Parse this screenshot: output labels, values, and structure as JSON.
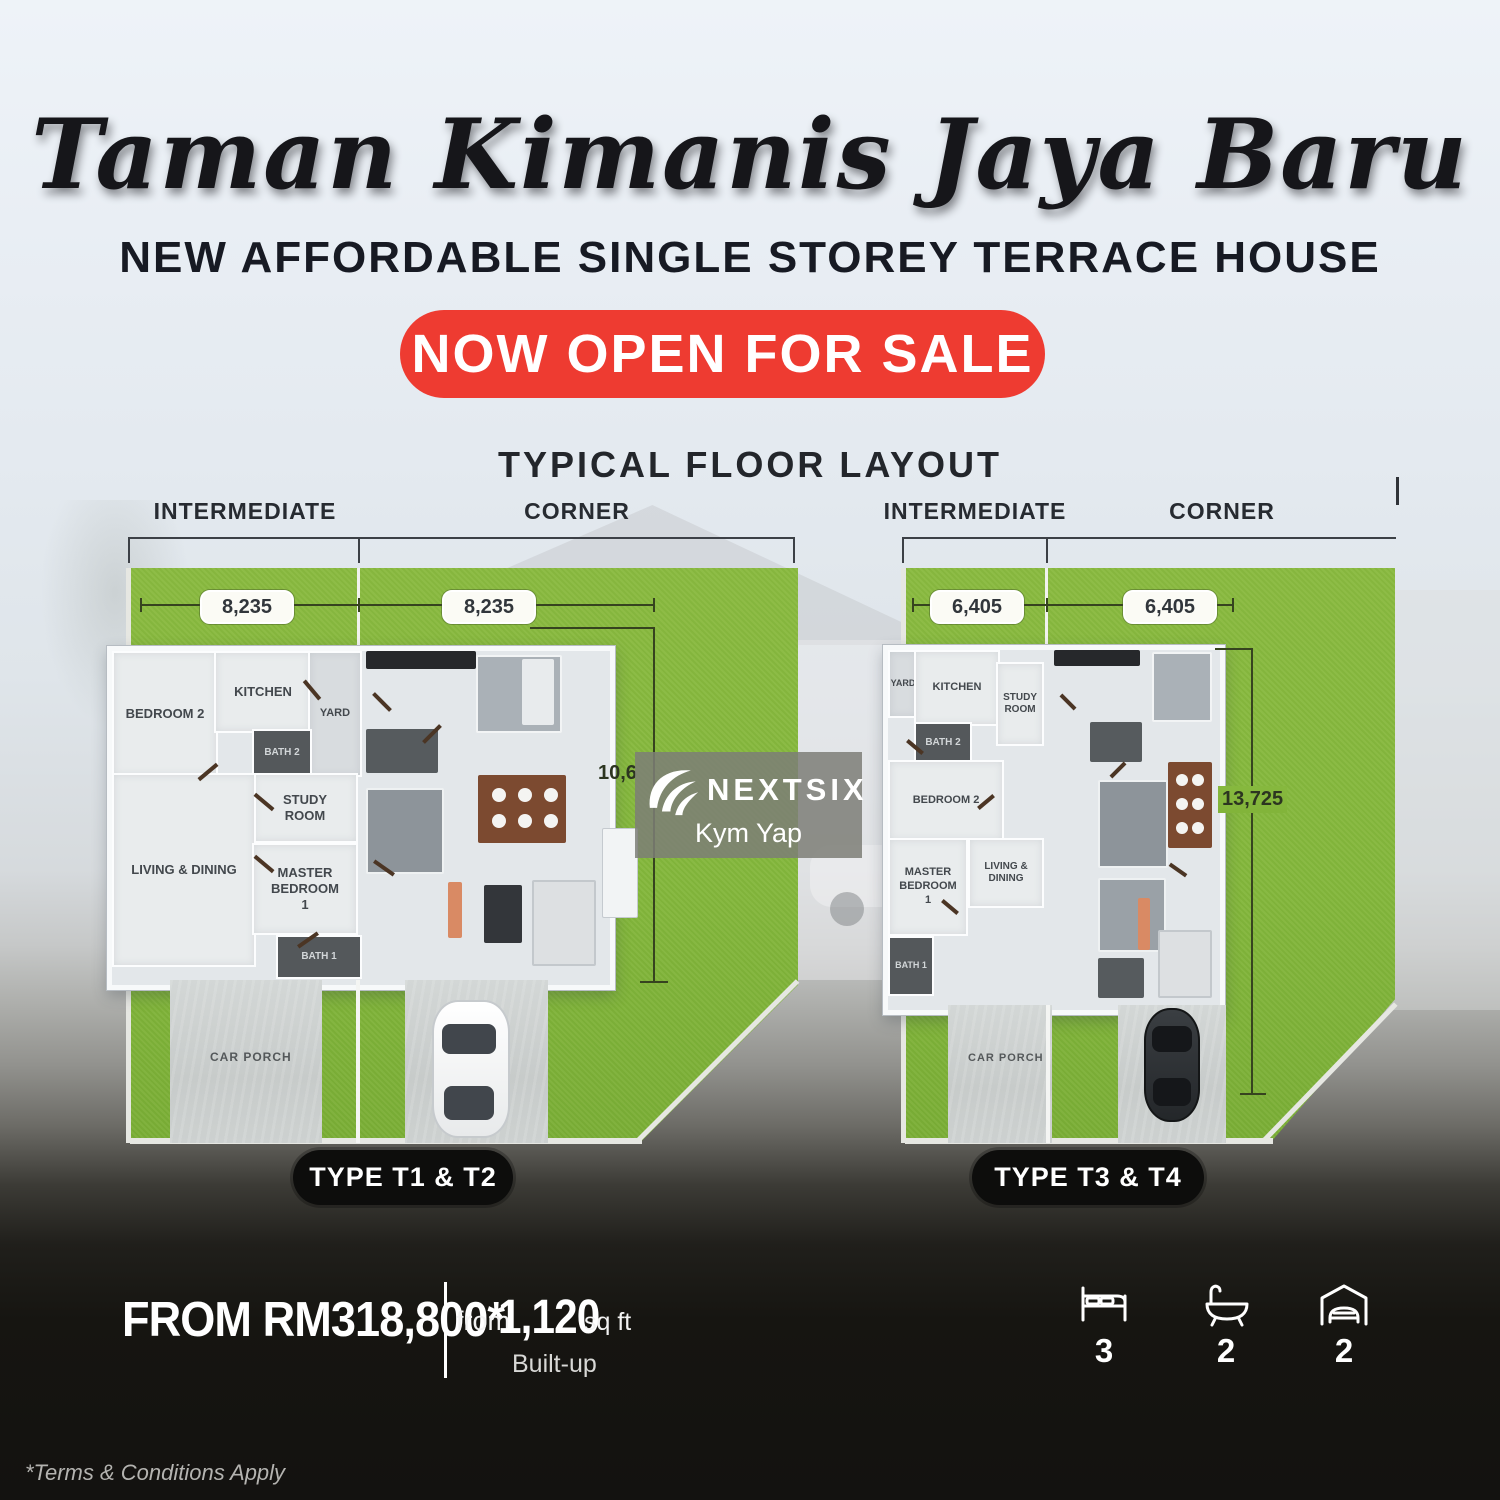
{
  "header": {
    "title": "Taman Kimanis Jaya Baru",
    "subtitle": "NEW AFFORDABLE SINGLE STOREY TERRACE HOUSE",
    "badge": "NOW OPEN FOR SALE"
  },
  "section_title": "TYPICAL FLOOR LAYOUT",
  "plan1": {
    "intermediate": "INTERMEDIATE",
    "corner": "CORNER",
    "dim_left": "8,235",
    "dim_right": "8,235",
    "dim_depth": "10,6",
    "rooms": {
      "bedroom2": "BEDROOM 2",
      "kitchen": "KITCHEN",
      "yard": "YARD",
      "bath2": "BATH 2",
      "study": "STUDY ROOM",
      "living": "LIVING & DINING",
      "master": "MASTER BEDROOM 1",
      "bath1": "BATH 1",
      "car_porch": "CAR PORCH"
    },
    "type_label": "TYPE T1 & T2"
  },
  "plan2": {
    "intermediate": "INTERMEDIATE",
    "corner": "CORNER",
    "dim_left": "6,405",
    "dim_right": "6,405",
    "dim_depth": "13,725",
    "rooms": {
      "bedroom2": "BEDROOM 2",
      "kitchen": "KITCHEN",
      "yard": "YARD",
      "bath2": "BATH 2",
      "study": "STUDY ROOM",
      "living": "LIVING & DINING",
      "master": "MASTER BEDROOM 1",
      "bath1": "BATH 1",
      "car_porch": "CAR PORCH"
    },
    "type_label": "TYPE T3 & T4"
  },
  "watermark": {
    "brand": "NEXTSIX",
    "agent": "Kym Yap"
  },
  "footer": {
    "price": "FROM RM318,800*",
    "from_label": "from",
    "area_value": "1,120",
    "area_unit": "sq ft",
    "builtup": "Built-up",
    "bed_count": "3",
    "bath_count": "2",
    "garage_count": "2",
    "terms": "*Terms & Conditions Apply"
  },
  "colors": {
    "accent_red": "#ee3b31",
    "grass_green": "#84b73c",
    "pill_black": "#0d0d0c"
  }
}
